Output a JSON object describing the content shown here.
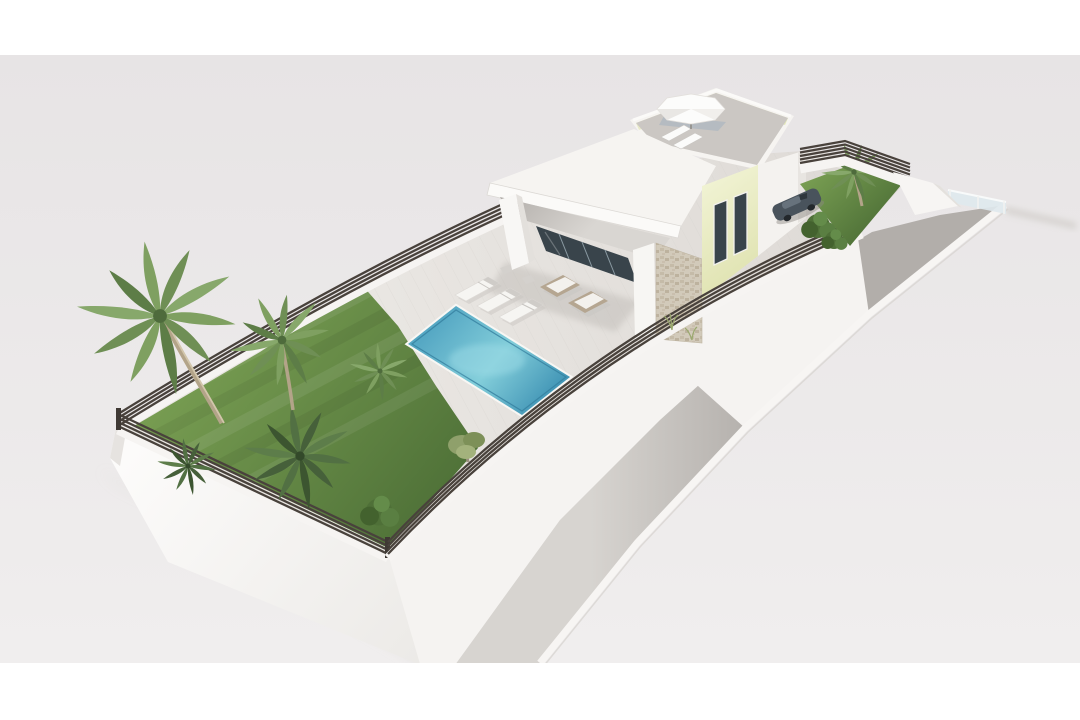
{
  "image": {
    "kind": "architectural-3d-render",
    "subject": "aerial view of a modern single-storey villa on a long rectangular plot",
    "frame_color": "#ffffff"
  },
  "palette": {
    "background_top": "#e7e4e5",
    "background_bottom": "#f0eeee",
    "terrace": "#e9e6e2",
    "terrace_far": "#ddd9d5",
    "plinth_light": "#fcfbfa",
    "plinth_shade": "#eceae7",
    "lawn_light": "#7da355",
    "lawn_dark": "#4c6e36",
    "pool_deep": "#3e92b4",
    "pool_mid": "#56a8c4",
    "pool_light": "#83ceda",
    "louver": "#49423c",
    "roof_accent": "#e9eac8",
    "roof_floor": "#cbc7c3",
    "glass_dark": "#39444b",
    "stone": "#d2caba",
    "driveway_light": "#d7d4d0",
    "driveway_dark": "#b2aeaa",
    "car_body": "#49535c",
    "umbrella": "#fcfcfb",
    "rattan": "#b5a691",
    "wall_white": "#f6f4f1"
  },
  "scene": {
    "plot": {
      "garden": {
        "tall_palms": 2,
        "low_palms": 3,
        "bushes": 2,
        "olive_trees": 1
      },
      "pool": {
        "shape": "rectangular",
        "loungers": 3,
        "side_tables": 2
      },
      "fences": {
        "style": "horizontal-louver",
        "sides": 4
      }
    },
    "house": {
      "style": "modern flat-roof",
      "canopy_columns": 2,
      "glass_door_panes": 4,
      "stone_feature_wall": 1,
      "bulkhead_windows": 2,
      "roof_terrace": {
        "parasol": 1,
        "loungers": 2,
        "parapet_accent": "pale-yellow"
      }
    },
    "side_garden": {
      "palms": 1,
      "bushes": 2
    },
    "driveway": {
      "type": "ramp",
      "cars": 1,
      "glass_gate_panels": 1
    }
  }
}
